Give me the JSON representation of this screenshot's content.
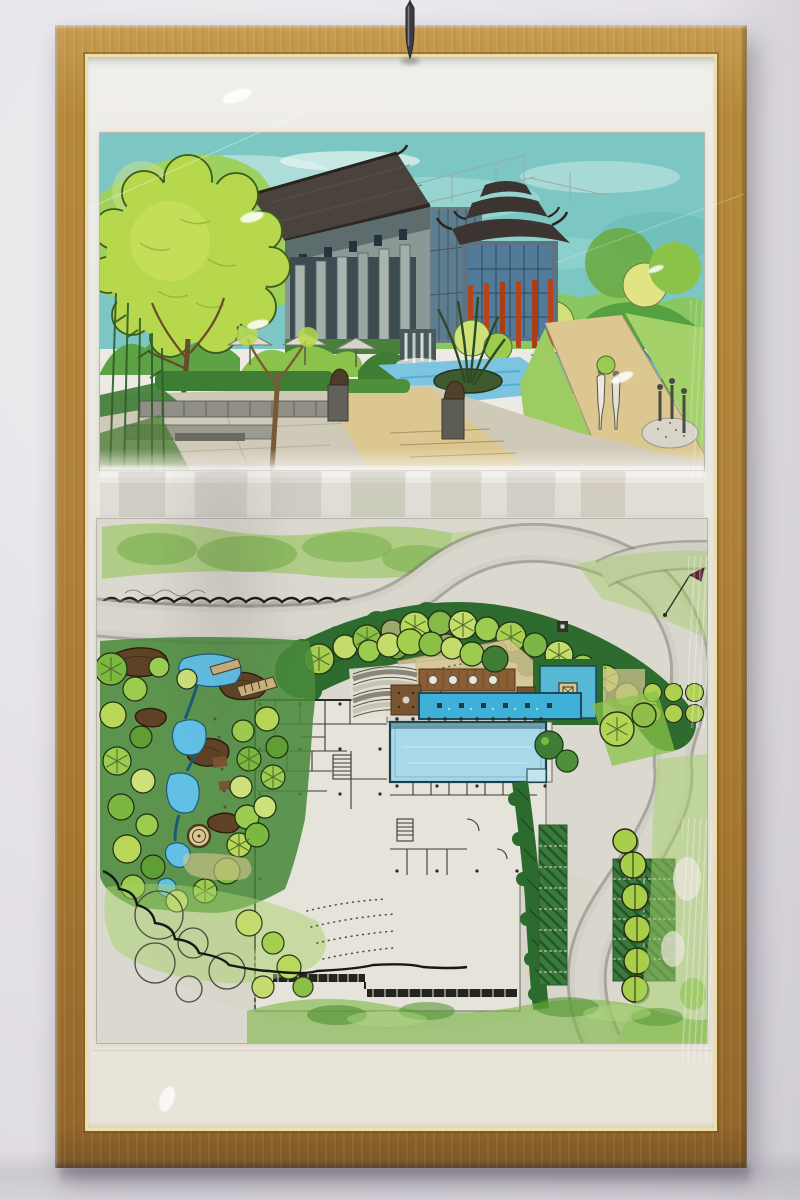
{
  "scene": {
    "setting": "gallery wall with framed artwork",
    "object": "wood-framed hand-drawn landscape architecture presentation behind glass",
    "panels": [
      {
        "name": "perspective-rendering",
        "subject": "marker and watercolor perspective of a courtyard building with Chinese-style roofs, red columns, pools, waterfall, sculptures, umbrellas and trees"
      },
      {
        "name": "site-plan-rendering",
        "subject": "hand-rendered landscape master plan with building floor plan, swimming pool, lap channel, square water court, pond and rock garden, curving roads, tree bosque and parking"
      }
    ],
    "fixture": "metal hanging hook above the frame",
    "glass_artifacts": "white highlight ovals, reflected picture frames of opposite wall, crinkled plastic streaks"
  },
  "colors": {
    "wall": "#e7e4e9",
    "wall_shadow": "#c9c5cc",
    "frame_wood": "#b0823a",
    "frame_wood_dark": "#8a5c28",
    "frame_lip": "#eedfa8",
    "mat": "#edebe6",
    "hook_metal": "#3c3c42",
    "sky": "#7cc7c4",
    "hill": "#9ed05e",
    "tree_light": "#b7d84c",
    "foliage_mid": "#8bc34a",
    "foliage_dark": "#2e6b2f",
    "roof": "#4a423c",
    "building": "#8c9896",
    "glass_blue": "#4f7d9e",
    "column_red": "#b5441c",
    "water": "#7cc4e0",
    "pool": "#a9d9e8",
    "channel": "#3fb0d8",
    "paper": "#dbd8cf",
    "road": "#d2cfc6",
    "khaki": "#d6c690",
    "rock_brown": "#5f4226",
    "deck_brown": "#8a5f36",
    "hedge": "#2c6b2e",
    "lawn": "#9ccc55",
    "plan_white": "#e6e3da",
    "ink": "#2a2a26"
  }
}
